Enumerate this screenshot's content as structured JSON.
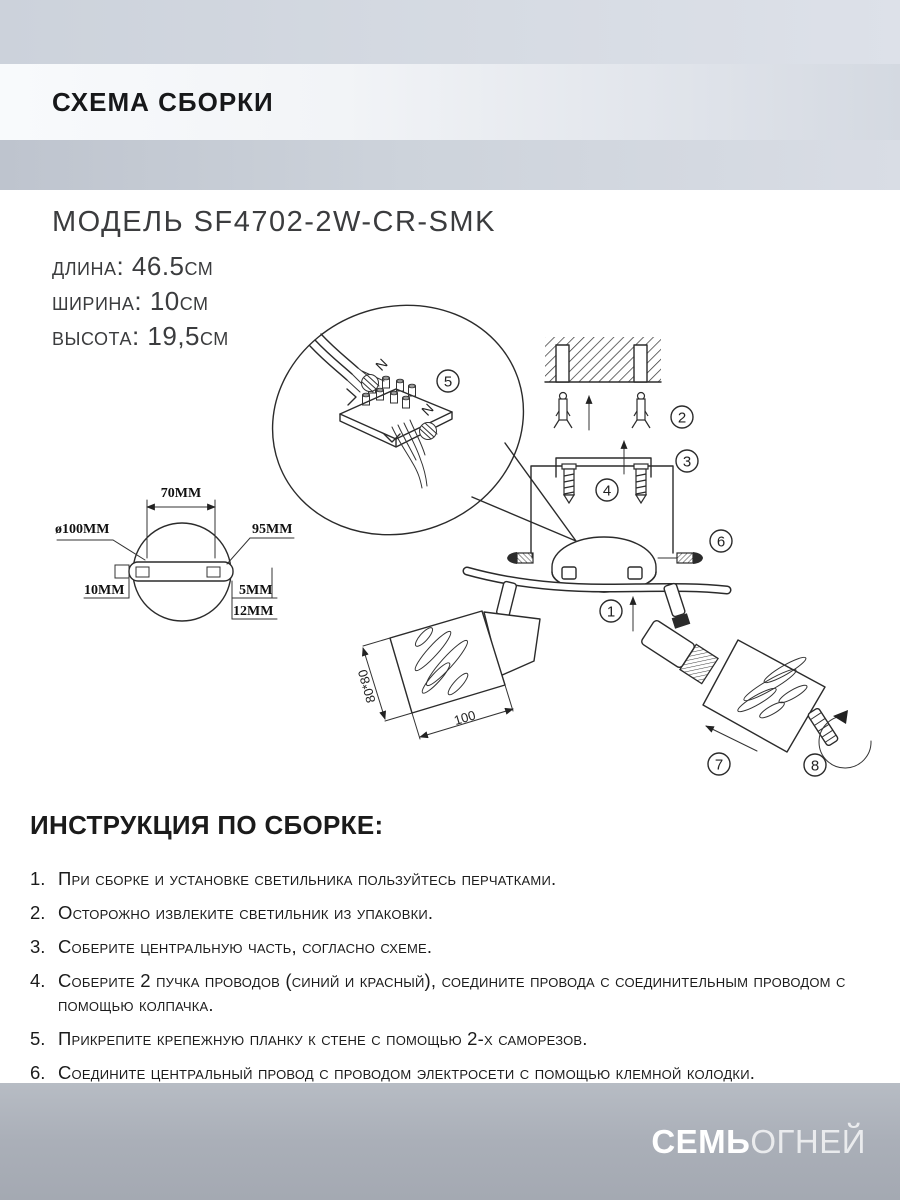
{
  "header": {
    "title": "СХЕМА СБОРКИ"
  },
  "model": {
    "name": "МОДЕЛЬ SF4702-2W-CR-SMK",
    "specs": [
      "длина: 46.5см",
      "ширина: 10см",
      "высота: 19,5см"
    ]
  },
  "diagram": {
    "callouts": [
      "1",
      "2",
      "3",
      "4",
      "5",
      "6",
      "7",
      "8"
    ],
    "wire_labels": {
      "top": "N",
      "side": "N"
    },
    "dimensions": {
      "plate_diameter": "ø100MM",
      "hole_spacing": "70MM",
      "plate_length": "95MM",
      "left_offset": "10MM",
      "right_offset": "5MM",
      "edge_depth": "12MM",
      "shade_size": "80*80",
      "shade_width": "100"
    }
  },
  "instructions": {
    "heading": "ИНСТРУКЦИЯ ПО СБОРКЕ:",
    "items": [
      {
        "num": "1.",
        "text": "При сборке и установке светильника пользуйтесь перчатками."
      },
      {
        "num": "2.",
        "text": "Осторожно извлеките светильник из упаковки."
      },
      {
        "num": "3.",
        "text": "Соберите центральную часть, согласно схеме."
      },
      {
        "num": "4.",
        "text": "Соберите 2 пучка проводов (синий и красный), соедините провода с соединительным проводом с помощью колпачка."
      },
      {
        "num": "5.",
        "text": "Прикрепите крепежную планку к стене с помощью 2-х саморезов."
      },
      {
        "num": "6.",
        "text": "Соедините центральный провод с проводом электросети с помощью клемной колодки."
      }
    ]
  },
  "footer": {
    "brand_bold": "СЕМЬ",
    "brand_light": "ОГНЕЙ"
  }
}
